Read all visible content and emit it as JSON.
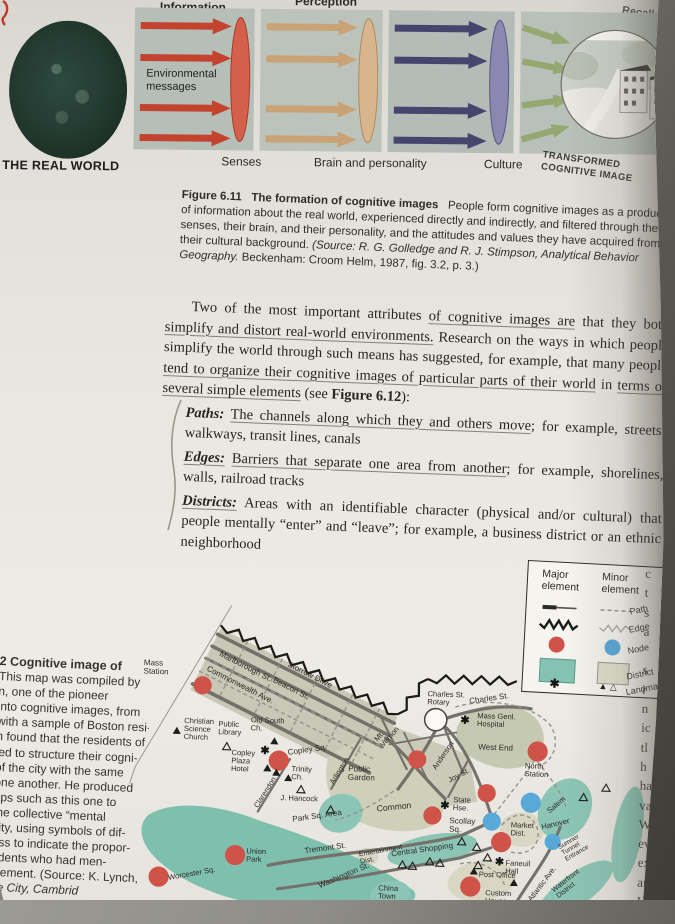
{
  "glyphs": {
    "star": "✱",
    "triangle_filled": "▲",
    "triangle_open": "△",
    "triangle_pair": "▲ △"
  },
  "fig611": {
    "label_information": "Information",
    "label_perception": "Perception",
    "label_recall": "Recall",
    "real_world": "THE REAL WORLD",
    "env_messages": "Environmental\nmessages",
    "label_senses": "Senses",
    "label_brain": "Brain and personality",
    "label_culture": "Culture",
    "label_transformed": "TRANSFORMED\nCOGNITIVE IMAGE"
  },
  "caption611": {
    "fig_label": "Figure 6.11",
    "fig_title": "The formation of cognitive images",
    "text": "People form cognitive images as a product of information about the real world, experienced directly and indirectly, and filtered through their senses, their brain, and their personality, and the attitudes and values they have acquired from their cultural background. ",
    "source_pre": "(Source: R. G. Golledge and R. J. Stimpson, ",
    "source_italic": "Analytical Behavior Geography.",
    "source_post": " Beckenham: Croom Helm, 1987, fig. 3.2, p. 3.)"
  },
  "body": {
    "p1_a": "Two of the most important attributes ",
    "p1_u1": "of cognitive images are",
    "p1_b": " that they both ",
    "p1_u2": "simplify and distort real-world environments.",
    "p1_c": " Research on the ways in which people simplify the world through such means has suggested, for example, that many people ",
    "p1_u3": "tend to organize their cognitive images of particular parts of their world",
    "p1_d": " in ",
    "p1_u4": "terms of several simple elements",
    "p1_e": " (see ",
    "p1_fig": "Figure 6.12",
    "p1_f": "):",
    "items": [
      {
        "term": "Paths:",
        "u": "The channels along which they and others move",
        "rest": "; for example, streets, walkways, transit lines, canals"
      },
      {
        "term": "Edges:",
        "u": "Barriers that separate one area from another",
        "rest": "; for example, shorelines, walls, railroad tracks"
      },
      {
        "term": "Districts:",
        "u": "Areas with an identifiable character (physical and/or cultural) that people mentally “enter” and “leave”",
        "rest": "; for example, a business district or an ethnic neighborhood"
      }
    ]
  },
  "fig612": {
    "caption_lines": [
      "2   Cognitive image of",
      "This map was compiled by",
      "n, one of the pioneer",
      "into cognitive images, from",
      "with a sample of Boston resi-",
      "n found that the residents of",
      "led to structure their cogni-",
      "of the city with the same",
      "one another. He produced",
      "aps such as this one to",
      "the collective “mental",
      "city, using symbols of dif-",
      "ess to indicate the propor-",
      "ndents who had men-",
      "element. (Source: K. Lynch,",
      "he City, Cambrid"
    ]
  },
  "legend": {
    "header_major": "Major\nelement",
    "header_minor": "Minor\nelement",
    "rows": {
      "path": "Path",
      "edge": "Edge",
      "node": "Node",
      "district": "District",
      "landmark": "Landmark"
    }
  },
  "map": {
    "labels": {
      "massStation": "Mass\nStation",
      "marlborough": "Marlborough St.",
      "commonwealth": "Commonwealth Ave.",
      "beacon": "Beacon St.",
      "storrow": "Storrow Drive",
      "christianScience": "Christian\nScience\nChurch",
      "publicLibrary": "Public\nLibrary",
      "oldSouth": "Old South\nCh.",
      "copleySq": "Copley Sq.",
      "copleyPlaza": "Copley\nPlaza\nHotel",
      "trinity": "Trinity\nCh.",
      "jHancock": "J. Hancock",
      "clarendon": "Clarendon",
      "arlington": "Arlington",
      "publicGarden": "Public\nGarden",
      "parkSq": "Park Sq. Area",
      "common": "Common",
      "mtVernon": "Mt.\nVernon",
      "anderson": "Anderson",
      "joySt": "Joy St.",
      "charlesRotary": "Charles St.\nRotary",
      "charlesSt": "Charles St.",
      "massGenl": "Mass Genl.\nHospital",
      "westEnd": "West End",
      "northStation": "North\nStation",
      "stateHse": "State\nHse.",
      "scollay": "Scollay\nSq.",
      "marketDist": "Market\nDist.",
      "salem": "Salem",
      "hanover": "Hanover",
      "sumner": "Sumner\nTunnel\nEntrance",
      "centralShopping": "Central Shopping",
      "entertainment": "Entertainment\nDist.",
      "faneuil": "Faneuil\nHall",
      "postOffice": "Post Office",
      "customHouse": "Custom\nHouse",
      "atlanticAve": "Atlantic Ave.",
      "waterfront": "Waterfront\nDistrict",
      "chinaTown": "China\nTown",
      "tremont": "Tremont St.",
      "washington": "Washington St.",
      "unionPark": "Union\nPark",
      "worcester": "Worcester Sq."
    }
  },
  "edge_letters": "c\nt\ns\na\n\ns\nr\nn\nic\ntl\nh\nha\nva\nW\nev\nex\nar\nHa"
}
